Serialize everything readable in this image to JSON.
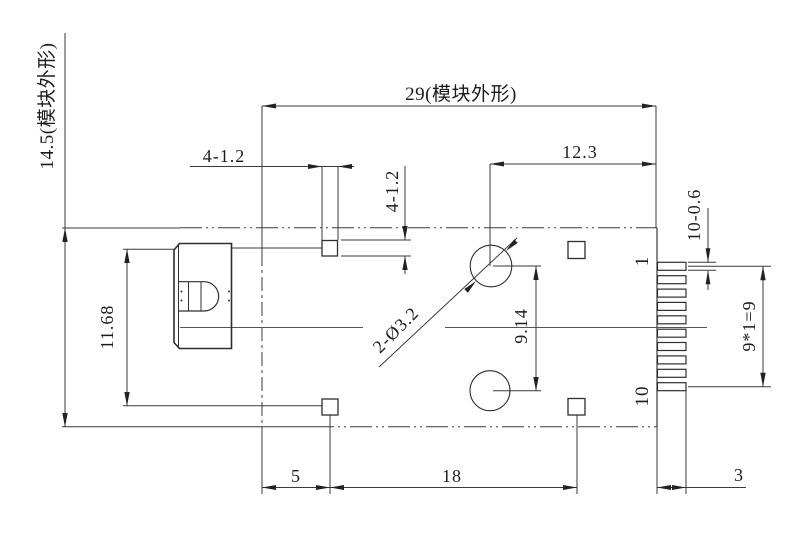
{
  "labels": {
    "module_height": "14.5(模块外形)",
    "module_width": "29(模块外形)",
    "hole_offset": "12.3",
    "pad_dim_top": "4-1.2",
    "pad_dim_side": "4-1.2",
    "connector_height": "11.68",
    "holes": "2-Ø3.2",
    "hole_spacing": "9.14",
    "pin_thickness": "10-0.6",
    "pin_first": "1",
    "pin_last": "10",
    "pin_span": "9*1=9",
    "pad_offset_left": "5",
    "pad_span": "18",
    "pin_length": "3"
  },
  "colors": {
    "background": "#ffffff",
    "line": "#3a3a3a",
    "text": "#1b1b1b"
  }
}
